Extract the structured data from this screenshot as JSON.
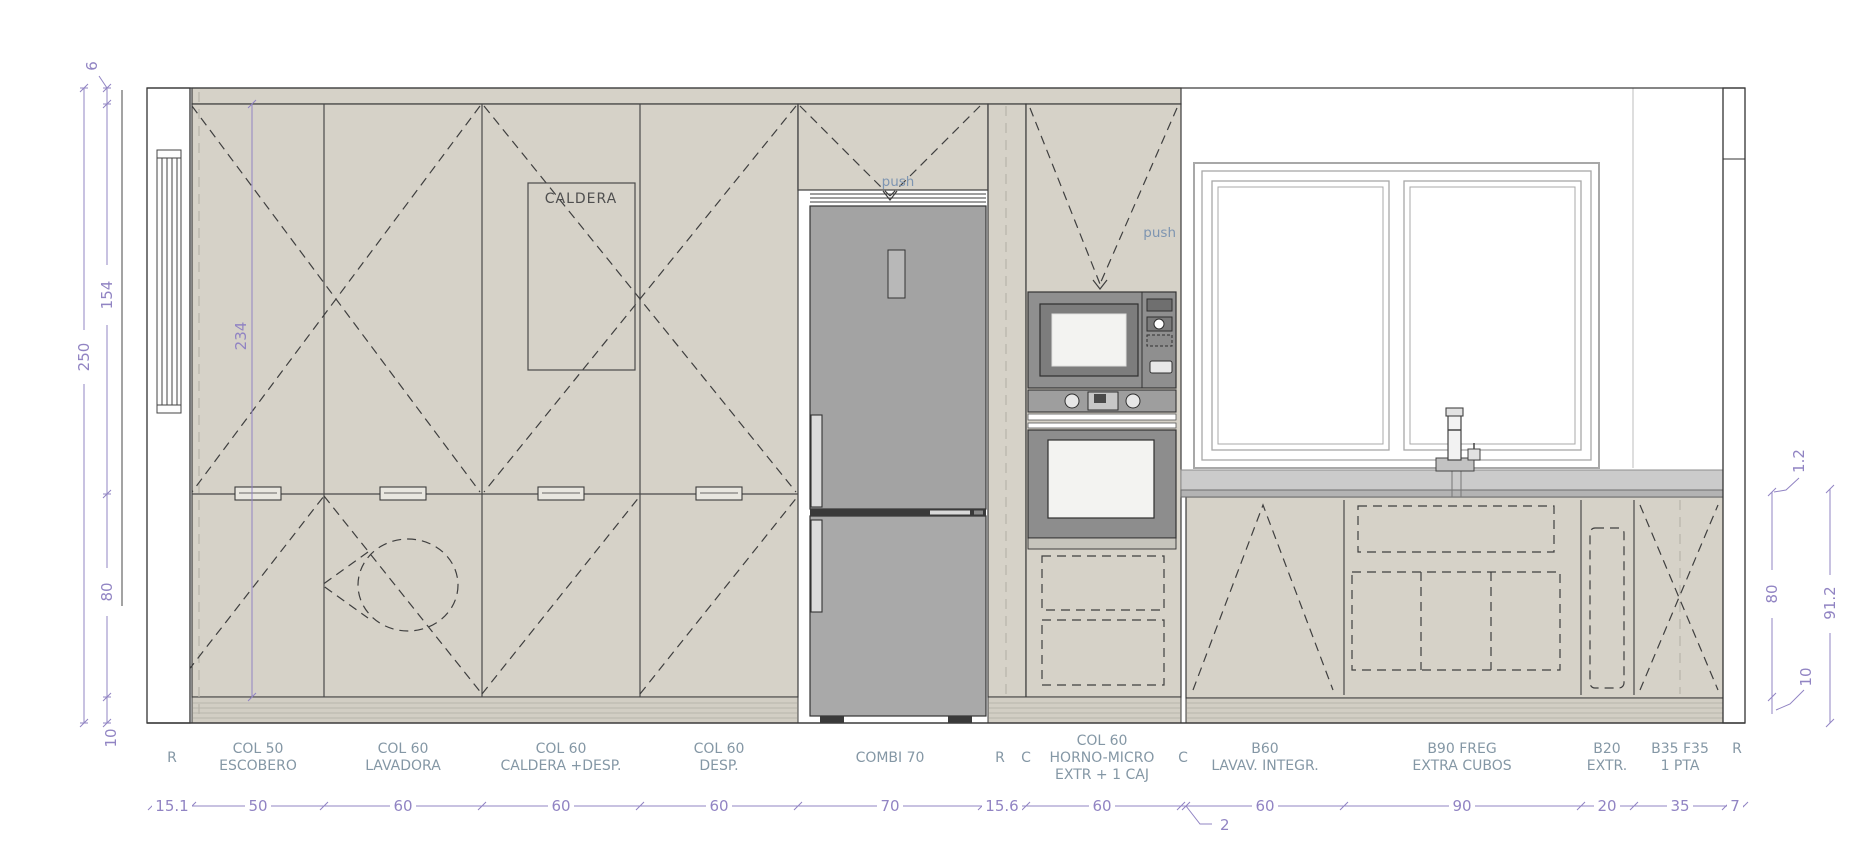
{
  "annotations": {
    "caldera": "CALDERA",
    "push_fridge": "push",
    "push_micro": "push"
  },
  "dims_left": {
    "soffit": "6",
    "upper": "154",
    "total": "250",
    "lower": "80",
    "plinth": "10",
    "door_height": "234"
  },
  "dims_right": {
    "counter": "1.2",
    "lower": "80",
    "total": "91.2",
    "plinth": "10"
  },
  "schedule": {
    "items": [
      {
        "l1": "R"
      },
      {
        "l1": "COL 50",
        "l2": "ESCOBERO"
      },
      {
        "l1": "COL 60",
        "l2": "LAVADORA"
      },
      {
        "l1": "COL 60",
        "l2": "CALDERA +DESP."
      },
      {
        "l1": "COL 60",
        "l2": "DESP."
      },
      {
        "l1": "COMBI 70"
      },
      {
        "l1": "R"
      },
      {
        "l1": "C"
      },
      {
        "l1": "COL 60",
        "l2": "HORNO-MICRO",
        "l3": "EXTR + 1 CAJ"
      },
      {
        "l1": "C"
      },
      {
        "l1": "B60",
        "l2": "LAVAV. INTEGR."
      },
      {
        "l1": "B90 FREG",
        "l2": "EXTRA CUBOS"
      },
      {
        "l1": "B20",
        "l2": "EXTR."
      },
      {
        "l1": "B35 F35",
        "l2": "1 PTA"
      },
      {
        "l1": "R"
      }
    ],
    "widths": [
      "15.1",
      "50",
      "60",
      "60",
      "60",
      "70",
      "15.6",
      "60",
      "2",
      "60",
      "90",
      "20",
      "35",
      "7"
    ]
  },
  "colors": {
    "cabinet": "#d6d2c8",
    "fridge": "#a6a6a6",
    "appliance": "#8f8f8f",
    "dimension": "#9184c3",
    "label": "#8497a5"
  }
}
